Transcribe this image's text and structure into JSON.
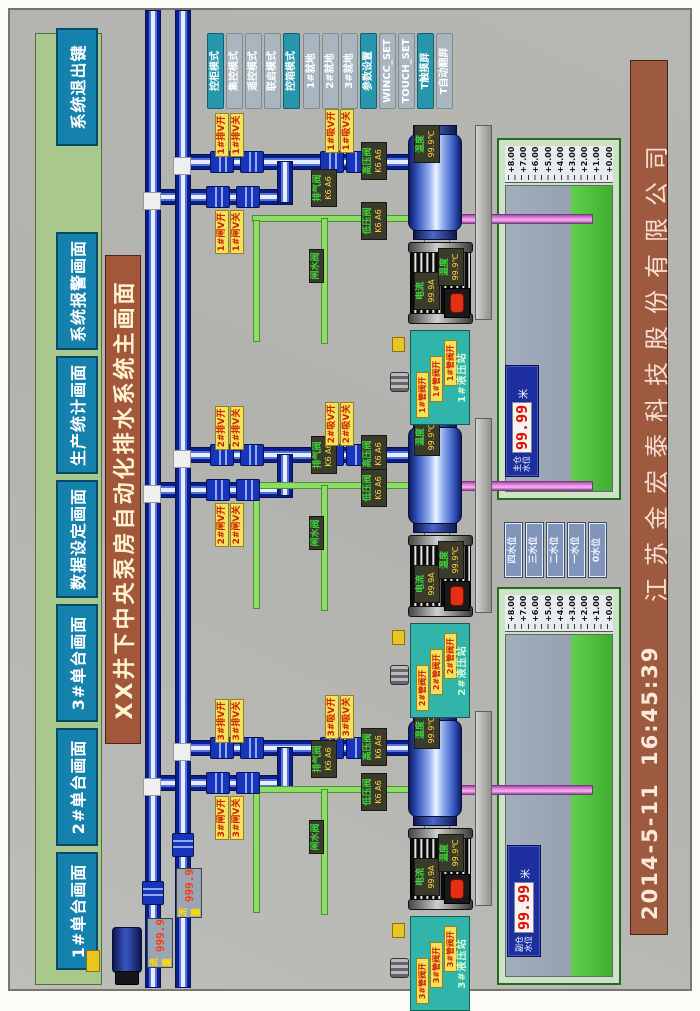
{
  "screen": {
    "title": "XX井下中央泵房自动化排水系统主画面",
    "datetime": {
      "date": "2014-5-11",
      "time": "16:45:39"
    },
    "company": "江苏金宏泰科技股份有限公司"
  },
  "nav_buttons": [
    "1#单台画面",
    "2#单台画面",
    "3#单台画面",
    "数据设定画面",
    "生产统计画面",
    "系统报警画面",
    "系统退出键"
  ],
  "mode_buttons": [
    {
      "label": "控柜模式",
      "active": true
    },
    {
      "label": "集控模式",
      "active": false
    },
    {
      "label": "遥控模式",
      "active": false
    },
    {
      "label": "联启模式",
      "active": false
    },
    {
      "label": "控箱模式",
      "active": true
    },
    {
      "label": "1#就地",
      "active": false
    },
    {
      "label": "2#就地",
      "active": false
    },
    {
      "label": "3#就地",
      "active": false
    },
    {
      "label": "参数设置",
      "active": true
    },
    {
      "label": "WINCC_SET",
      "active": false
    },
    {
      "label": "TOUCH_SET",
      "active": false
    },
    {
      "label": "T触摸屏",
      "active": true
    },
    {
      "label": "T自动翻屏",
      "active": false
    }
  ],
  "flow_meters": [
    {
      "label": "流量",
      "value": "999.9"
    },
    {
      "label": "流量",
      "value": "999.9"
    }
  ],
  "level_buttons": [
    "四水位",
    "三水位",
    "二水位",
    "一水位",
    "0水位"
  ],
  "sumps": [
    {
      "name_line1": "副仓",
      "name_line2": "水位",
      "value": "99.99",
      "unit": "米",
      "scale": [
        "+8.00",
        "+7.00",
        "+6.00",
        "+5.00",
        "+4.00",
        "+3.00",
        "+2.00",
        "+1.00",
        "+0.00"
      ]
    },
    {
      "name_line1": "主仓",
      "name_line2": "水位",
      "value": "99.99",
      "unit": "米",
      "scale": [
        "+8.00",
        "+7.00",
        "+6.00",
        "+5.00",
        "+4.00",
        "+3.00",
        "+2.00",
        "+1.00",
        "+0.00"
      ]
    }
  ],
  "units": [
    {
      "id": "3#",
      "pump_gauge": {
        "label": "温度",
        "value": "99.9℃"
      },
      "motor_current": {
        "label": "电流",
        "value": "99.9A"
      },
      "motor_temp": {
        "label": "温度",
        "value": "99.9℃"
      },
      "valve_tags": {
        "drain_open": "3#排V开",
        "drain_close": "3#排V关",
        "gate_open": "3#闸V开",
        "gate_close": "3#闸V关",
        "suction_open": "3#吸V开",
        "suction_close": "3#吸V关"
      },
      "pipe_labels": {
        "high_pressure": {
          "name": "高压阀",
          "status": "K6 A6"
        },
        "low_pressure": {
          "name": "低压阀",
          "status": "K6 A6"
        },
        "vent": {
          "name": "排气阀",
          "status": "K6 A6"
        },
        "gate_water": "闸水阀"
      },
      "hydraulic": {
        "title": "3#液压站",
        "indicator": "3#管阀开"
      }
    },
    {
      "id": "2#",
      "pump_gauge": {
        "label": "温度",
        "value": "99.9℃"
      },
      "motor_current": {
        "label": "电流",
        "value": "99.9A"
      },
      "motor_temp": {
        "label": "温度",
        "value": "99.9℃"
      },
      "valve_tags": {
        "drain_open": "2#排V开",
        "drain_close": "2#排V关",
        "gate_open": "2#闸V开",
        "gate_close": "2#闸V关",
        "suction_open": "2#吸V开",
        "suction_close": "2#吸V关"
      },
      "pipe_labels": {
        "high_pressure": {
          "name": "高压阀",
          "status": "K6 A6"
        },
        "low_pressure": {
          "name": "低压阀",
          "status": "K6 A6"
        },
        "vent": {
          "name": "排气阀",
          "status": "K6 A6"
        },
        "gate_water": "闸水阀"
      },
      "hydraulic": {
        "title": "2#液压站",
        "indicator": "2#管阀开"
      }
    },
    {
      "id": "1#",
      "pump_gauge": {
        "label": "温度",
        "value": "99.9℃"
      },
      "motor_current": {
        "label": "电流",
        "value": "99.9A"
      },
      "motor_temp": {
        "label": "温度",
        "value": "99.9℃"
      },
      "valve_tags": {
        "drain_open": "1#排V开",
        "drain_close": "1#排V关",
        "gate_open": "1#闸V开",
        "gate_close": "1#闸V关",
        "suction_open": "1#吸V开",
        "suction_close": "1#吸V关"
      },
      "pipe_labels": {
        "high_pressure": {
          "name": "高压阀",
          "status": "K6 A6"
        },
        "low_pressure": {
          "name": "低压阀",
          "status": "K6 A6"
        },
        "vent": {
          "name": "排气阀",
          "status": "K6 A6"
        },
        "gate_water": "闸水阀"
      },
      "hydraulic": {
        "title": "1#液压站",
        "indicator": "1#管阀开"
      }
    }
  ],
  "colors": {
    "nav_green": "#a8c88c",
    "button_blue": "#1581ad",
    "title_brown": "#a2573a",
    "mode_teal": "#2795ac",
    "mode_gray": "#a9b6c0",
    "pipe_blue": "#0a1e8c",
    "pipe_green": "#8edd66",
    "pipe_pink": "#e07ae0",
    "water_green": "#4ec23e",
    "alarm_red": "#e23014",
    "label_yellow": "#f2e25c",
    "led_red": "#e01000"
  }
}
